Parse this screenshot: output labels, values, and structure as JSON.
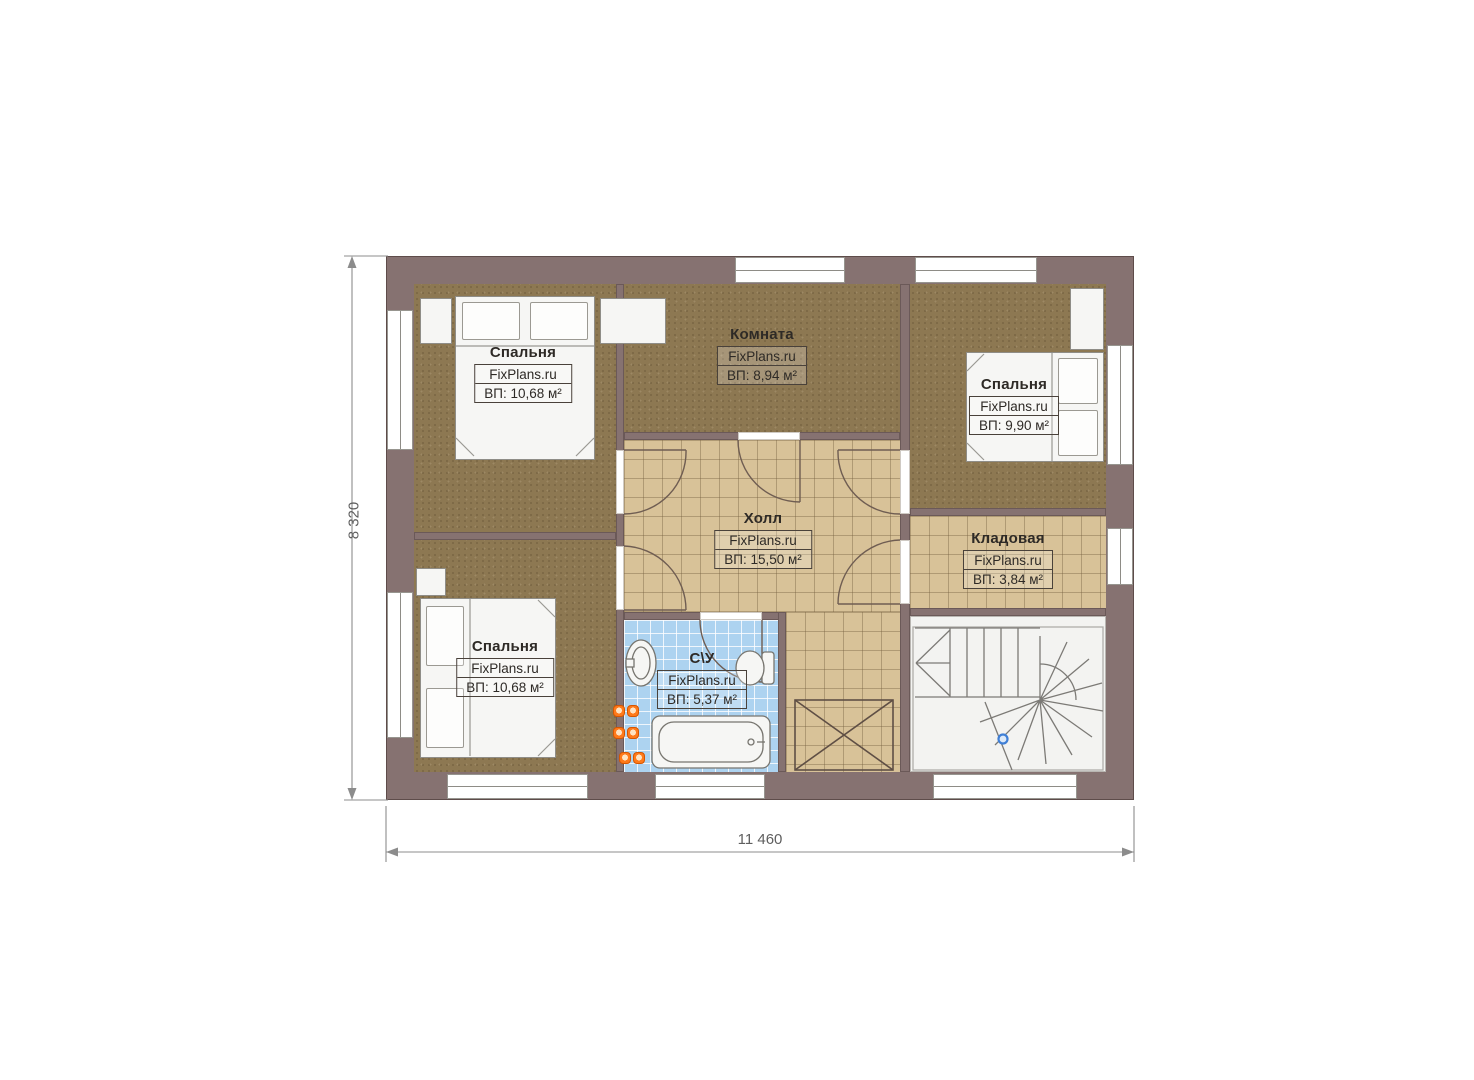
{
  "plan": {
    "brand": "FixPlans.ru",
    "dimension_height": "8 320",
    "dimension_width": "11 460",
    "rooms": {
      "bedroom_top_left": {
        "name": "Спальня",
        "area": "ВП: 10,68 м²"
      },
      "room_top_middle": {
        "name": "Комната",
        "area": "ВП: 8,94 м²"
      },
      "bedroom_top_right": {
        "name": "Спальня",
        "area": "ВП: 9,90 м²"
      },
      "hall": {
        "name": "Холл",
        "area": "ВП: 15,50 м²"
      },
      "storage": {
        "name": "Кладовая",
        "area": "ВП: 3,84 м²"
      },
      "bedroom_bottom_left": {
        "name": "Спальня",
        "area": "ВП: 10,68 м²"
      },
      "bathroom": {
        "name": "С\\У",
        "area": "ВП: 5,37 м²"
      }
    },
    "colors": {
      "wall": "#867271",
      "floor_dark": "#8d7852",
      "floor_tile": "#d8c298",
      "floor_bath": "#add3f0",
      "stairs": "#f3f3f1",
      "fixture": "#f6f6f4",
      "accent_orange": "#ff7a1a",
      "marker_blue": "#3f7fd6",
      "text": "#2e2a26"
    }
  }
}
